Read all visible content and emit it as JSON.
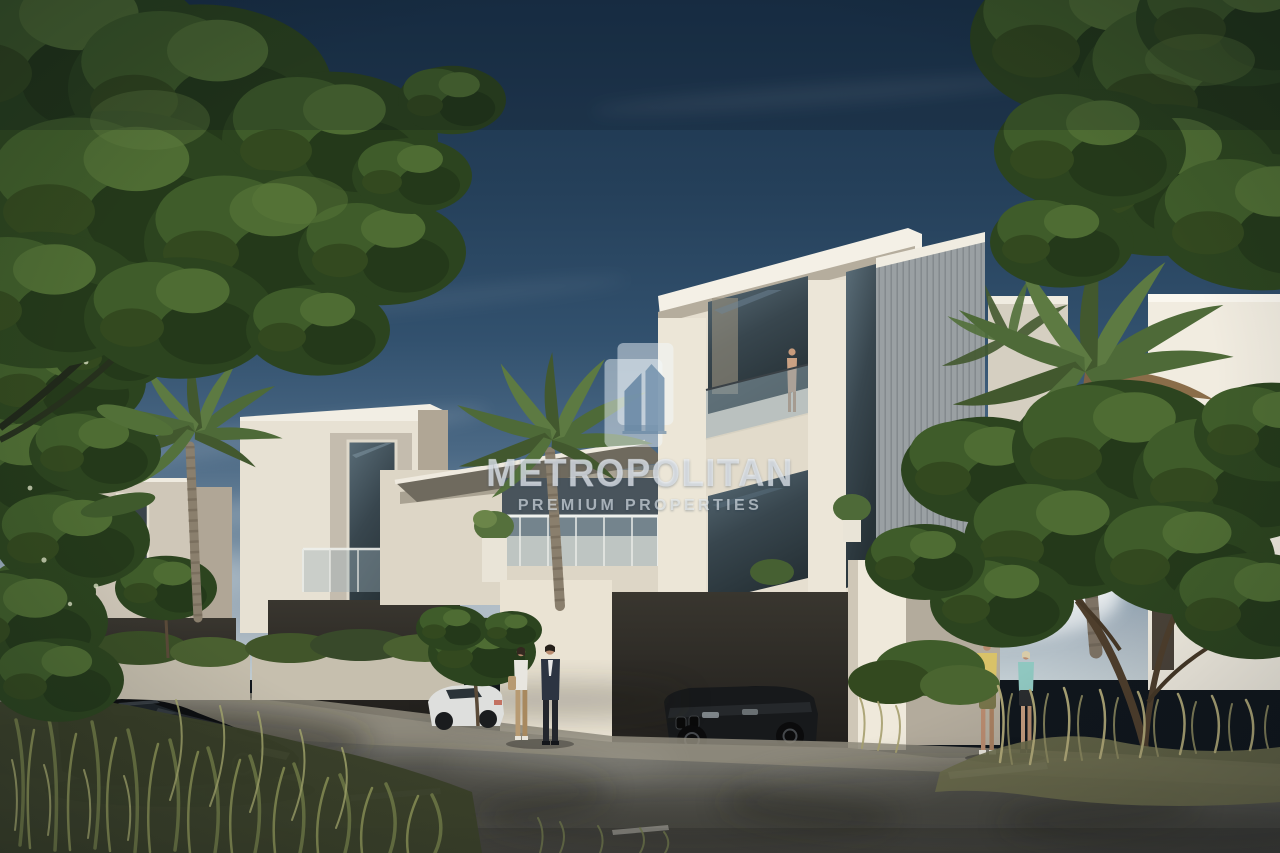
{
  "watermark": {
    "brand": "METROPOLITAN",
    "tagline": "PREMIUM PROPERTIES",
    "logo_icon": "skyscrapers-badge"
  },
  "palette": {
    "sky_top": "#1b334b",
    "sky_horizon": "#c2cdd2",
    "facade_sunlit": "#efe9db",
    "facade_shadow": "#b2a898",
    "window_glass": "#3b4a52",
    "asphalt": "#6e6d66",
    "foliage_dark": "#2c441f",
    "palm_green": "#5d7444",
    "dry_grass": "#b3ab79",
    "watermark_white": "rgba(236,243,249,0.55)"
  }
}
